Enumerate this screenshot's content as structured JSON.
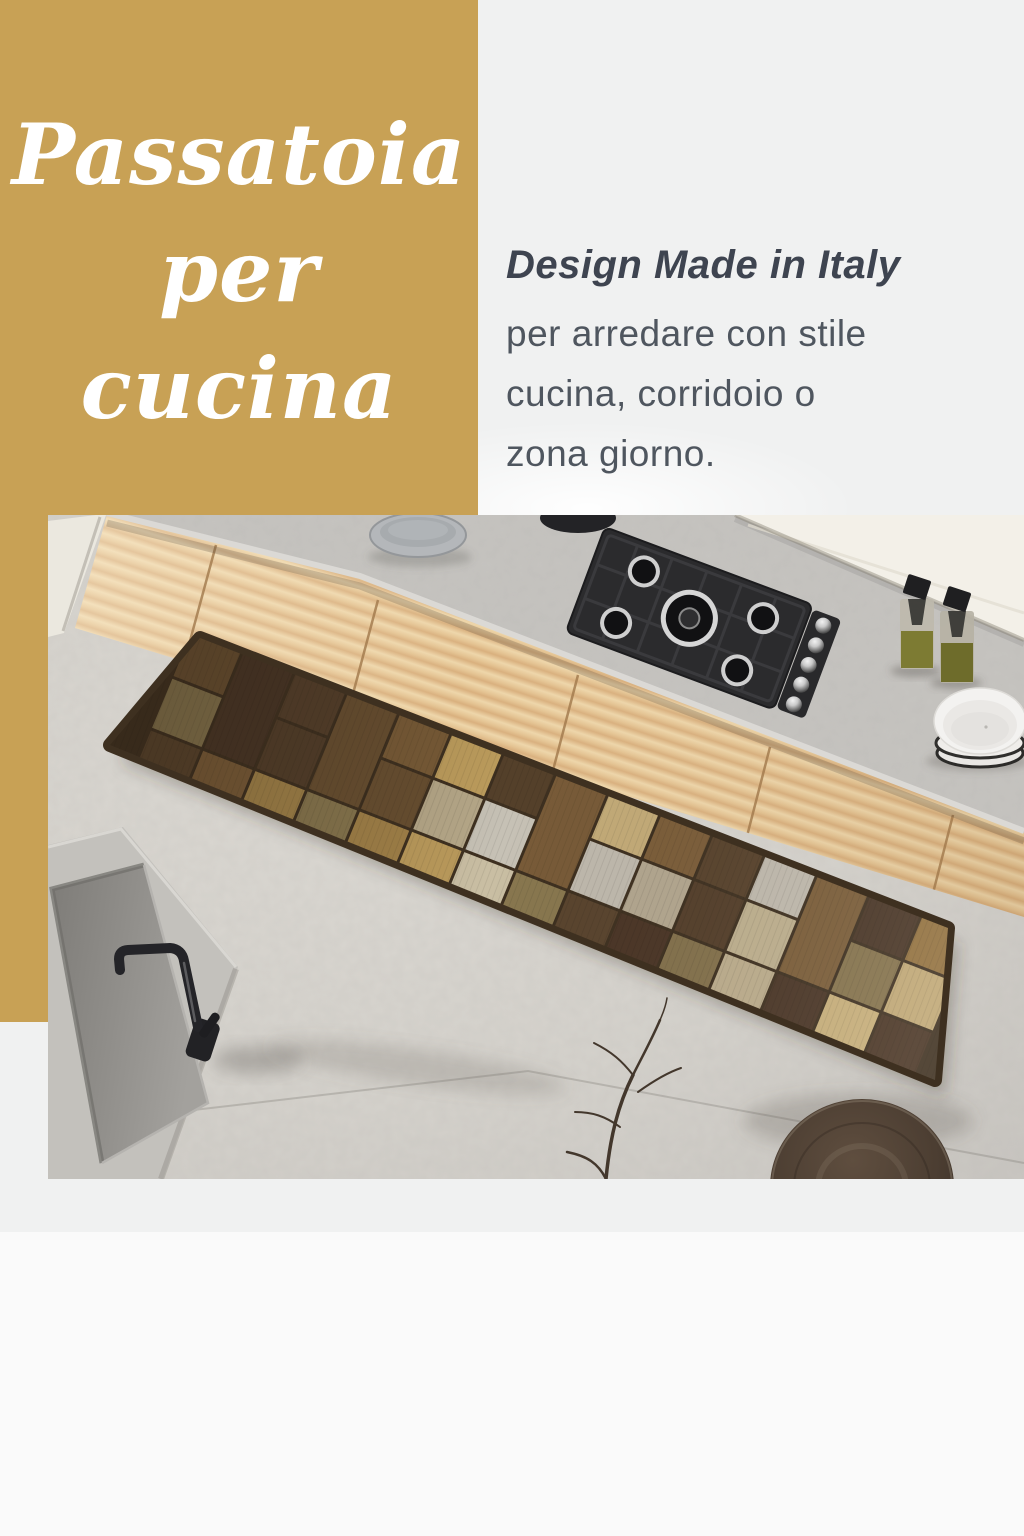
{
  "title": {
    "line1": "Passatoia",
    "line2": "per cucina"
  },
  "tagline": {
    "heading": "Design Made in Italy",
    "lines": [
      "per arredare con stile",
      "cucina, corridoio o",
      "zona giorno."
    ]
  },
  "colors": {
    "gold_bg": "#c8a155",
    "panel_bg": "#f0f1f1",
    "page_bg": "#fafafa",
    "title_text": "#ffffff",
    "heading_text": "#3e4450",
    "body_text": "#4f565f",
    "floor": "#d5d2cc",
    "countertop": "#c6c4c0",
    "wall": "#f3f0e8",
    "wood": "#e9cfa0",
    "hob": "#2b2b2d",
    "rug_backing": "#3e3020"
  },
  "rug_palette": [
    "#4a3626",
    "#55402b",
    "#5a452e",
    "#6d5233",
    "#7d5f3a",
    "#93713f",
    "#a8874c",
    "#bf9f5e",
    "#c9b07c",
    "#c3b493",
    "#cfc4a9",
    "#c7bfae",
    "#ccc7bb",
    "#b7ab94",
    "#8a7850"
  ]
}
